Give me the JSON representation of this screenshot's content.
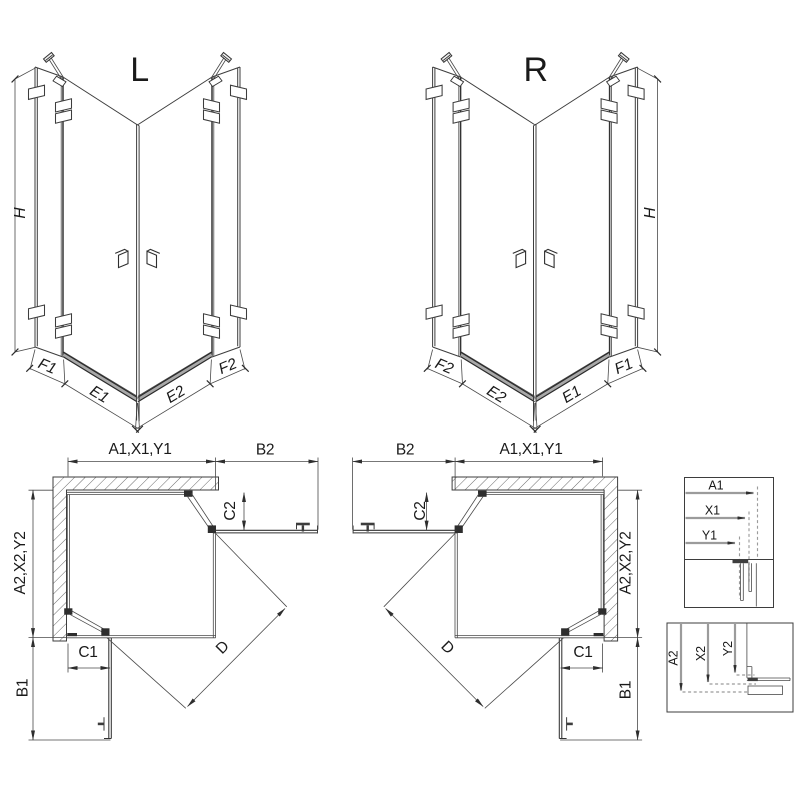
{
  "drawing": {
    "front_left": {
      "label": "L",
      "height_dim": "H",
      "width_dims": [
        "F1",
        "E1",
        "E2",
        "F2"
      ]
    },
    "front_right": {
      "label": "R",
      "height_dim": "H",
      "width_dims": [
        "F2",
        "E2",
        "E1",
        "F1"
      ]
    },
    "plan_left": {
      "top_dim": "A1,X1,Y1",
      "side_panel_top": "B2",
      "door_top": "C2",
      "depth_dim": "A2,X2,Y2",
      "door_bottom": "C1",
      "side_panel_bottom": "B1",
      "diagonal": "D"
    },
    "plan_right": {
      "top_dim": "A1,X1,Y1",
      "side_panel_top": "B2",
      "door_top": "C2",
      "depth_dim": "A2,X2,Y2",
      "door_bottom": "C1",
      "side_panel_bottom": "B1",
      "diagonal": "D"
    },
    "detail_top": {
      "dims": [
        "A1",
        "X1",
        "Y1"
      ]
    },
    "detail_bottom": {
      "dims": [
        "A2",
        "X2",
        "Y2"
      ]
    },
    "colors": {
      "line": "#3d3d3d",
      "dark": "#262626",
      "gray_dim": "#9b9b9b",
      "text": "#1a1a1a",
      "background": "#ffffff"
    }
  }
}
